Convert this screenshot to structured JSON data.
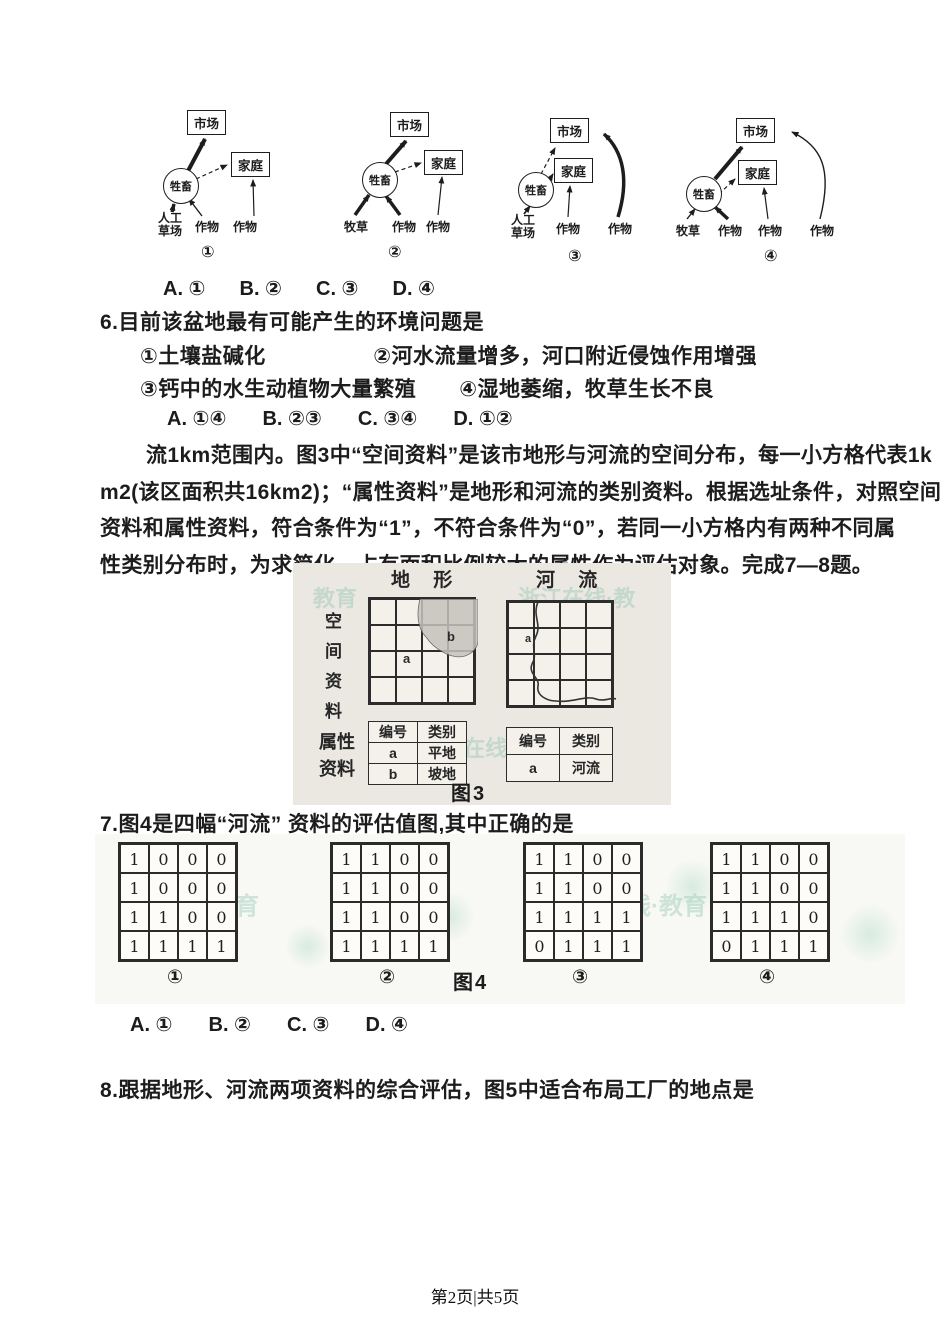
{
  "flow_diagrams": {
    "diagrams": [
      {
        "market": "市场",
        "livestock": "牲畜",
        "family": "家庭",
        "inputs": [
          "人工草场",
          "作物",
          "作物"
        ],
        "caption": "①"
      },
      {
        "market": "市场",
        "livestock": "牲畜",
        "family": "家庭",
        "inputs": [
          "牧草",
          "作物",
          "作物"
        ],
        "caption": "②"
      },
      {
        "market": "市场",
        "livestock": "牲畜",
        "family": "家庭",
        "inputs": [
          "人工草场",
          "作物",
          "作物"
        ],
        "caption": "③"
      },
      {
        "market": "市场",
        "livestock": "牲畜",
        "family": "家庭",
        "inputs": [
          "牧草",
          "作物",
          "作物",
          "作物"
        ],
        "caption": "④"
      }
    ]
  },
  "q5": {
    "options": [
      "A. ①",
      "B. ②",
      "C. ③",
      "D. ④"
    ]
  },
  "q6": {
    "stem": "6.目前该盆地最有可能产生的环境问题是",
    "choice_line1": "①土壤盐碱化　　　　　②河水流量增多，河口附近侵蚀作用增强",
    "choice_line2": "③钙中的水生动植物大量繁殖　　④湿地萎缩，牧草生长不良",
    "options": [
      "A. ①④",
      "B. ②③",
      "C. ③④",
      "D. ①②"
    ]
  },
  "passage": {
    "lines": [
      "流1km范围内。图3中“空间资料”是该市地形与河流的空间分布，每一小方格代表1k",
      "m2(该区面积共16km2)；“属性资料”是地形和河流的类别资料。根据选址条件，对照空间",
      "资料和属性资料，符合条件为“1”，不符合条件为“0”，若同一小方格内有两种不同属",
      "性类别分布时，为求简化，占有面积比例较大的属性作为评估对象。完成7—8题。"
    ]
  },
  "figure3": {
    "caption": "图3",
    "header_terrain": "地 形",
    "header_river": "河 流",
    "row_label_spatial": "空间资料",
    "row_label_attr": "属性资料",
    "terrain_grid_labels": {
      "a": "a",
      "b": "b"
    },
    "river_grid_label": "a",
    "terrain_table": {
      "h": [
        "编号",
        "类别"
      ],
      "rows": [
        [
          "a",
          "平地"
        ],
        [
          "b",
          "坡地"
        ]
      ]
    },
    "river_table": {
      "h": [
        "编号",
        "类别"
      ],
      "rows": [
        [
          "a",
          "河流"
        ]
      ]
    }
  },
  "q7": {
    "stem": "7.图4是四幅“河流” 资料的评估值图,其中正确的是",
    "options": [
      "A. ①",
      "B. ②",
      "C. ③",
      "D. ④"
    ]
  },
  "figure4": {
    "caption": "图4",
    "grids": [
      {
        "label": "①",
        "rows": [
          [
            1,
            0,
            0,
            0
          ],
          [
            1,
            0,
            0,
            0
          ],
          [
            1,
            1,
            0,
            0
          ],
          [
            1,
            1,
            1,
            1
          ]
        ]
      },
      {
        "label": "②",
        "rows": [
          [
            1,
            1,
            0,
            0
          ],
          [
            1,
            1,
            0,
            0
          ],
          [
            1,
            1,
            0,
            0
          ],
          [
            1,
            1,
            1,
            1
          ]
        ]
      },
      {
        "label": "③",
        "rows": [
          [
            1,
            1,
            0,
            0
          ],
          [
            1,
            1,
            0,
            0
          ],
          [
            1,
            1,
            1,
            1
          ],
          [
            0,
            1,
            1,
            1
          ]
        ]
      },
      {
        "label": "④",
        "rows": [
          [
            1,
            1,
            0,
            0
          ],
          [
            1,
            1,
            0,
            0
          ],
          [
            1,
            1,
            1,
            0
          ],
          [
            0,
            1,
            1,
            1
          ]
        ]
      }
    ]
  },
  "q8": {
    "stem": "8.跟据地形、河流两项资料的综合评估，图5中适合布局工厂的地点是"
  },
  "watermarks": {
    "w1": "教育",
    "w2": "浙江在线·教",
    "w3": "浙江 在线",
    "w4": "在线·教育",
    "w5": "浙江在线·教育"
  },
  "footer": {
    "text": "第2页|共5页"
  },
  "colors": {
    "ink": "#1c1c1c",
    "figure_bg": "#ebe8e1",
    "watermark": "#6eb49b",
    "blob_shade": "#c6c3bc"
  }
}
